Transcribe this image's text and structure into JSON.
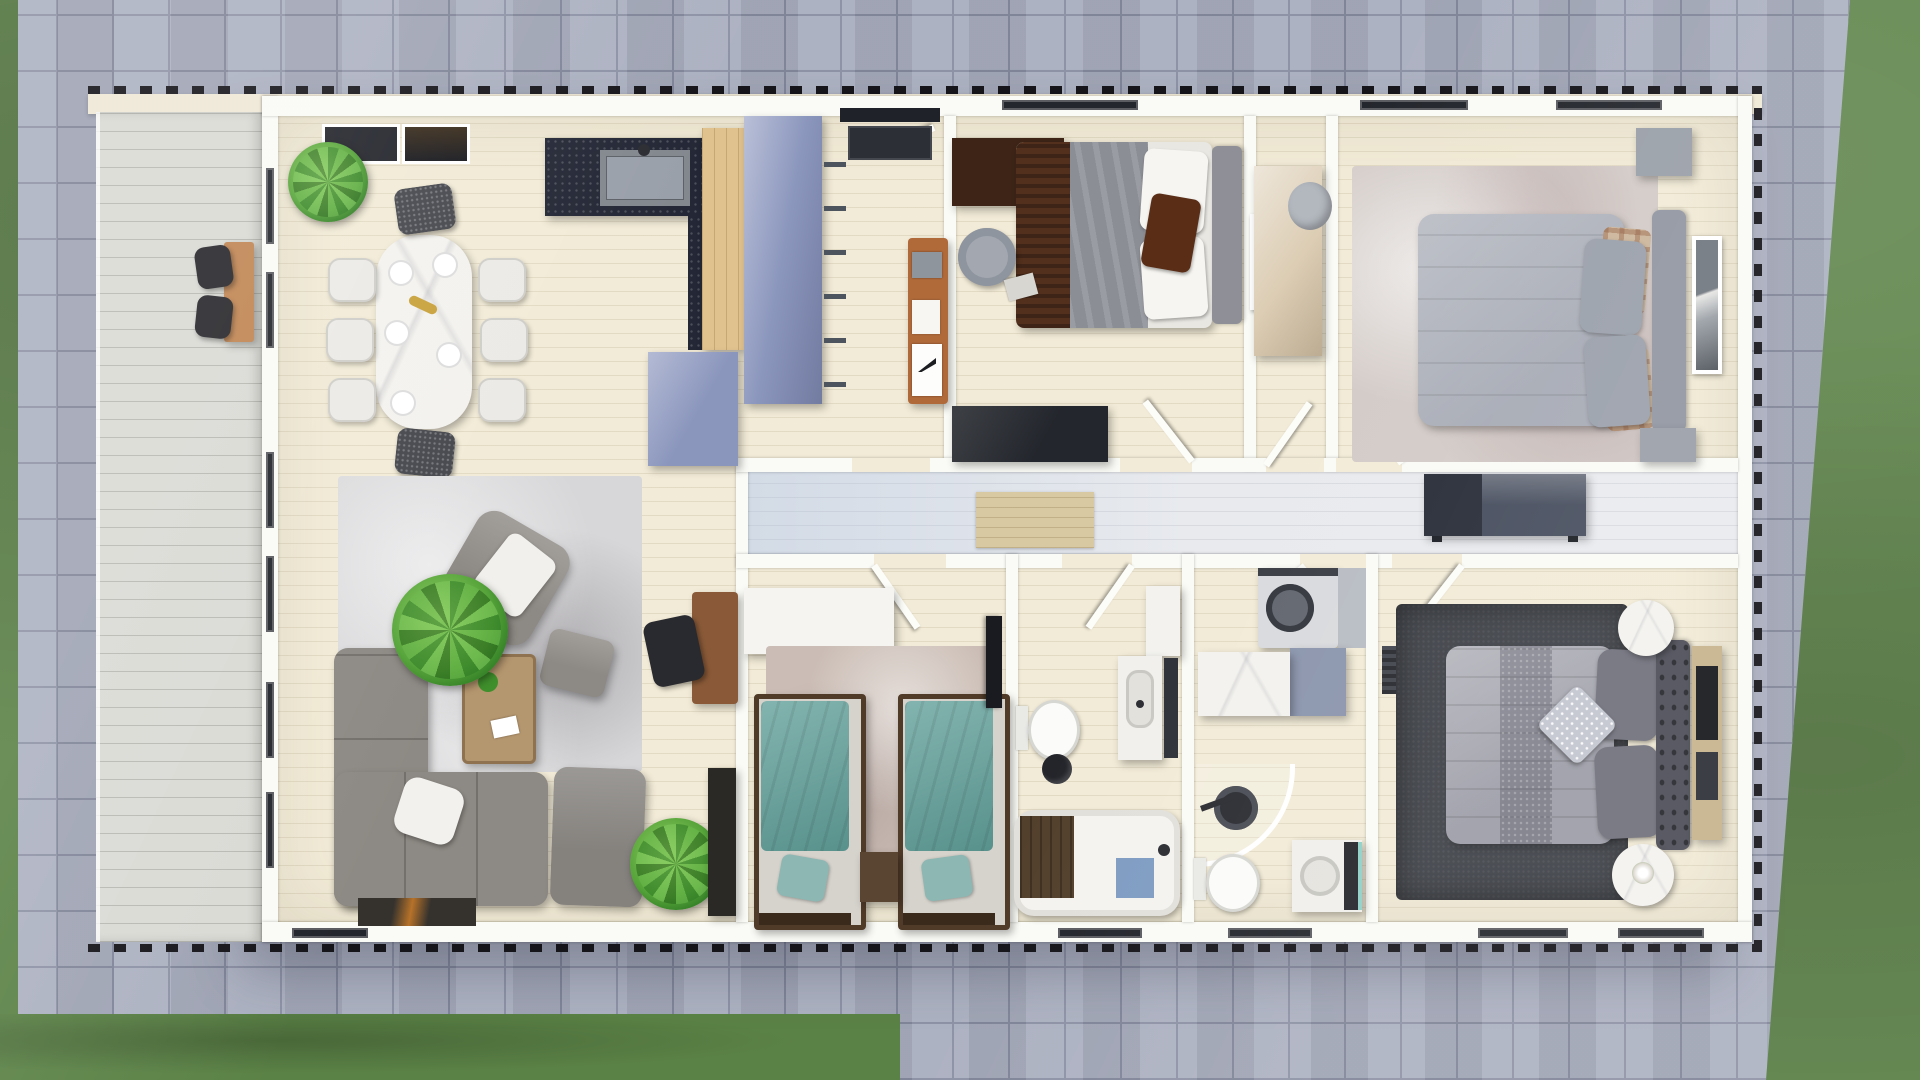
{
  "scene": {
    "kind": "photoreal-top-down-floorplan-render",
    "view": "overhead cutaway of single-storey house",
    "visible_text": "none"
  },
  "palette": {
    "grass": "#5b8246",
    "pavement": "#a8adbe",
    "pavement_line": "#878ca0",
    "deck": "#dadad5",
    "deck_line": "#b9b9b3",
    "fascia": "#efe8d6",
    "roof_dash": "#15151a",
    "wall": "#fafaf6",
    "floor": "#f2ebd7",
    "corridor_floor": "#e8eaee",
    "granite": "#242836",
    "oak": "#e0c28f",
    "blue_unit": "#8b96bd",
    "teal": "#6fa29d",
    "sofa": "#8d8984",
    "rug_light": "#d7d7d9",
    "rug_mauve": "#cbbdb5",
    "rug_pale": "#d3cbc7",
    "rug_charcoal": "#3d4046",
    "bed_gray": "#a7abb5",
    "pillow_dark": "#70707c",
    "headboard_dark": "#4b4c56",
    "marble": "#f3f2ee",
    "dark": "#23262c",
    "mat_beige": "#d9c9a2",
    "brown_blanket": "#53301d",
    "wood_brown": "#8a5a38",
    "wood_dark": "#53402c",
    "white_soft": "#f4f3ef"
  },
  "rooms": [
    {
      "id": "porch-deck",
      "furniture": [
        "porch-desk",
        "porch-chair",
        "porch-chair"
      ]
    },
    {
      "id": "living-dining-kitchen",
      "furniture": [
        "dining-table",
        "white-dining-chairs-x6",
        "dark-dining-chairs-x2",
        "skylight-panels-x2",
        "potted-plant",
        "kitchen-granite-counter",
        "kitchen-sink",
        "tall-oak-cabinet",
        "blue-fridge-unit",
        "blue-pantry-wall",
        "area-rug",
        "armchair-with-throw",
        "ottoman",
        "coffee-table",
        "l-shaped-sofa",
        "chaise-seat",
        "white-pillow",
        "palm-plant",
        "door-mat",
        "wall-desk",
        "desk-chair",
        "dark-cabinet",
        "floor-plant"
      ]
    },
    {
      "id": "entry-hall",
      "furniture": [
        "entry-door",
        "entry-mat",
        "wire-wall-racks",
        "wood-desk-unit",
        "poster"
      ]
    },
    {
      "id": "bedroom-top-middle",
      "furniture": [
        "double-bed-brown-gray",
        "gray-headboard",
        "white-pillows",
        "brown-accent-pillow",
        "dark-brown-dresser",
        "desk-chair",
        "book",
        "leaning-art-frame",
        "wall-tv"
      ]
    },
    {
      "id": "closet-nook",
      "furniture": [
        "oak-wardrobe",
        "laundry-basket"
      ]
    },
    {
      "id": "bedroom-top-right",
      "furniture": [
        "distressed-rug",
        "gray-duvet-bed",
        "plaid-pillows",
        "gray-pillows",
        "upholstered-headboard",
        "nightstand-top",
        "nightstand-bottom",
        "leaning-canvas"
      ]
    },
    {
      "id": "corridor",
      "furniture": [
        "runner-mat",
        "dark-sideboard",
        "open-door-leaves"
      ]
    },
    {
      "id": "kids-twin-bedroom",
      "furniture": [
        "white-wardrobe",
        "area-rug",
        "single-bed-teal-left",
        "single-bed-teal-right",
        "teal-pillows",
        "dark-nightstand",
        "wall-tv"
      ]
    },
    {
      "id": "bathroom-with-tub",
      "furniture": [
        "toilet",
        "waste-bin",
        "vanity-sink",
        "mirror-panel",
        "tall-white-cabinet",
        "bathtub",
        "wood-bath-tray",
        "blue-bath-mat",
        "faucet"
      ]
    },
    {
      "id": "bathroom-laundry",
      "furniture": [
        "washing-machine",
        "gray-counter",
        "marble-island",
        "blue-side-cabinet",
        "corner-shower",
        "shower-head",
        "toilet",
        "vanity-sink-round",
        "dark-cabinet-front",
        "teal-accent"
      ]
    },
    {
      "id": "bedroom-bottom-right",
      "furniture": [
        "charcoal-rug",
        "gray-duvet-bed",
        "dark-gray-pillows-x2",
        "sparkle-pillow",
        "tufted-headboard",
        "round-marble-side-table-top",
        "round-marble-side-table-bottom",
        "flower-vase",
        "media-dresser",
        "wall-vent"
      ]
    }
  ]
}
